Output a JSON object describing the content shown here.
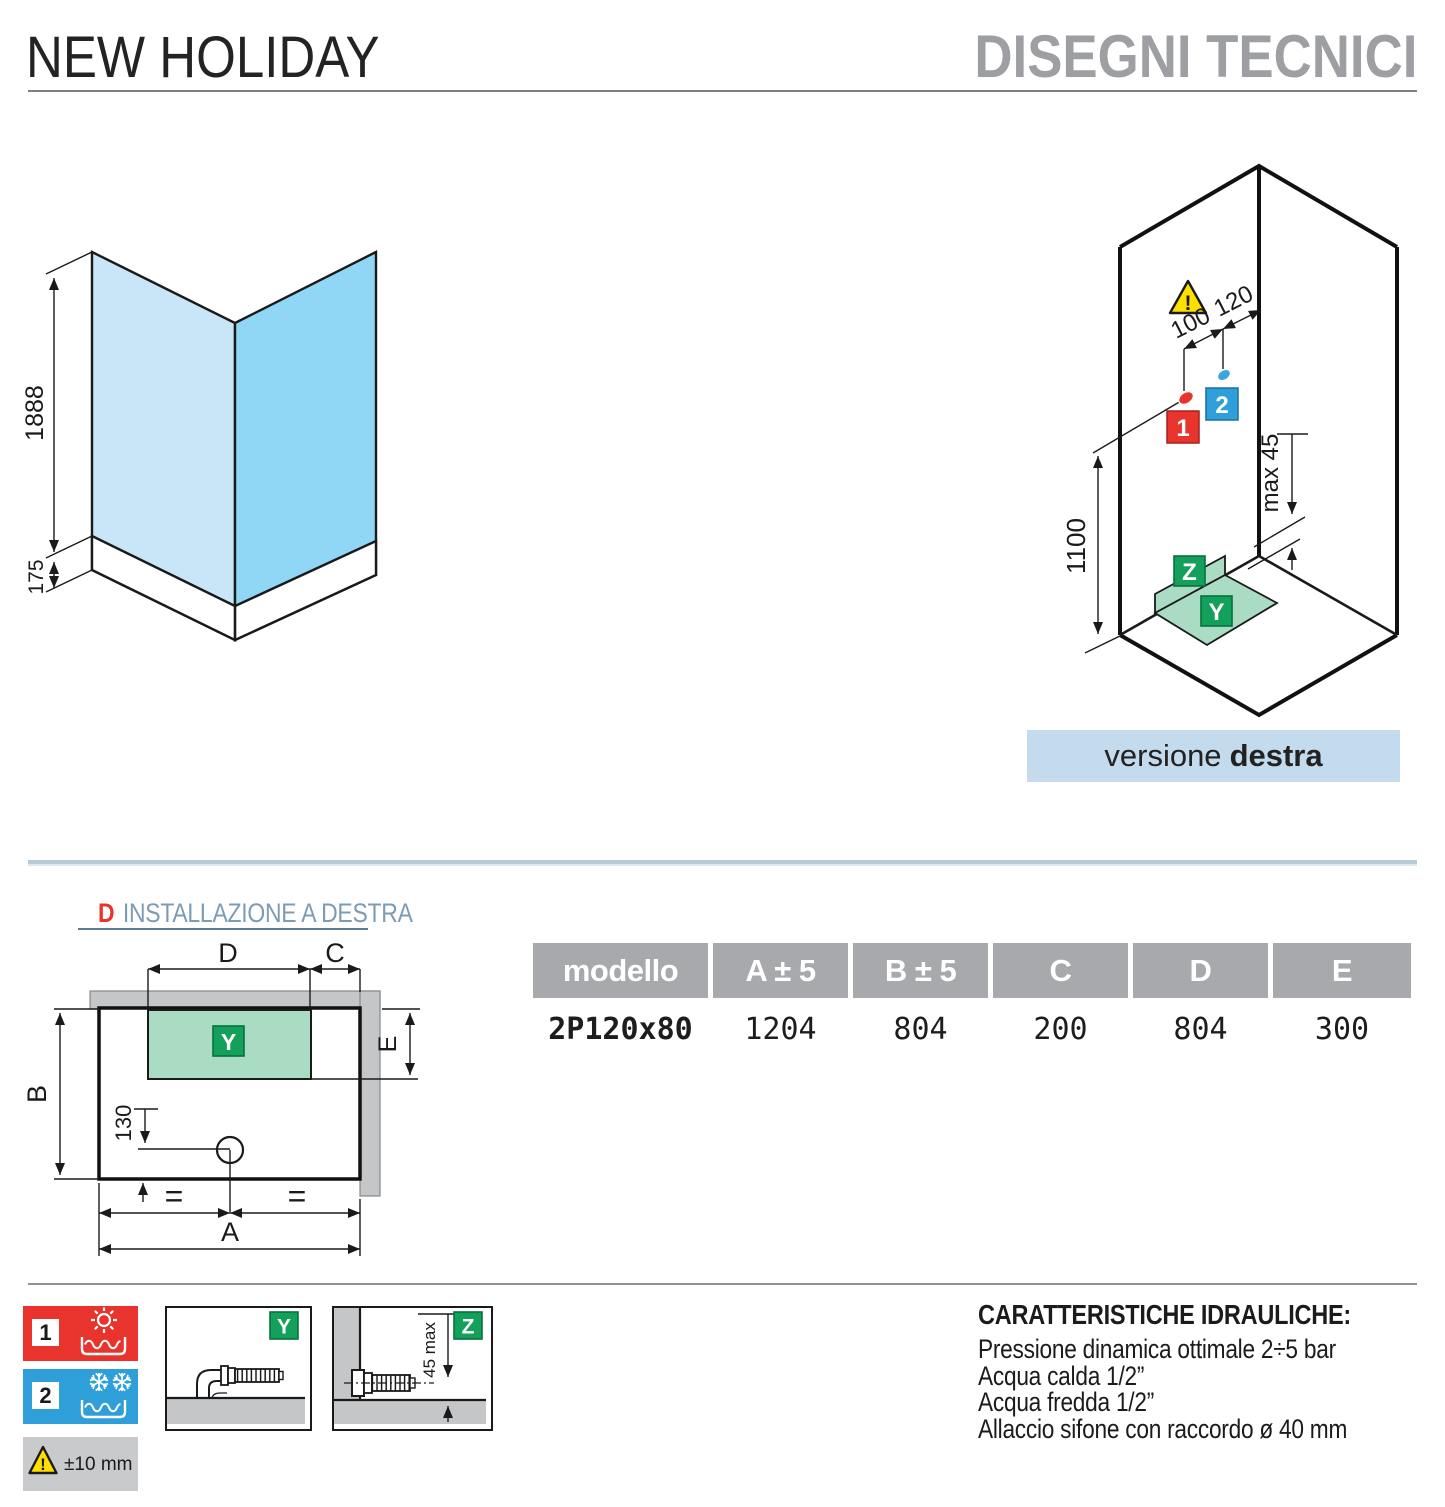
{
  "header": {
    "product": "NEW HOLIDAY",
    "section": "DISEGNI TECNICI"
  },
  "corner_drawing": {
    "height": "1888",
    "tray_height": "175"
  },
  "iso_drawing": {
    "warning": "!",
    "dim_hot_offset": "100",
    "dim_cold_offset": "120",
    "dim_height": "1100",
    "dim_wall_gap": "max 45",
    "hot_tag": "1",
    "cold_tag": "2",
    "drain_tag": "Z",
    "tray_tag": "Y"
  },
  "version_bar": {
    "prefix": "versione",
    "variant": "destra"
  },
  "installation": {
    "letter": "D",
    "title": "INSTALLAZIONE A DESTRA",
    "dim_d": "D",
    "dim_c": "C",
    "dim_e": "E",
    "dim_b": "B",
    "dim_a": "A",
    "dim_drain": "130",
    "equal_left": "=",
    "equal_right": "=",
    "tray_tag": "Y"
  },
  "table": {
    "headers": [
      "modello",
      "A ± 5",
      "B ± 5",
      "C",
      "D",
      "E"
    ],
    "row": [
      "2P120x80",
      "1204",
      "804",
      "200",
      "804",
      "300"
    ]
  },
  "legend": {
    "hot_tag": "1",
    "cold_tag": "2",
    "warning": "!",
    "tolerance": "±10 mm",
    "detail_y": {
      "tag": "Y"
    },
    "detail_z": {
      "tag": "Z",
      "dim": "45 max"
    }
  },
  "hydraulics": {
    "title": "CARATTERISTICHE IDRAULICHE:",
    "lines": [
      "Pressione dinamica ottimale 2÷5 bar",
      "Acqua calda 1/2”",
      "Acqua fredda 1/2”",
      "Allaccio sifone con raccordo ø 40 mm"
    ]
  },
  "colors": {
    "accent_red": "#e8342c",
    "accent_blue": "#2e9fd8",
    "accent_green": "#13a05a",
    "glass_left": "#c9e6f8",
    "glass_right": "#90d7f5",
    "tray_green": "#a9dcc3",
    "wall_gray": "#c5c6c8",
    "table_header_gray": "#a7a9ac",
    "version_bar_blue": "#c3dbed",
    "warning_yellow": "#ffdf00",
    "section_title_gray": "#9d9fa2",
    "install_title_blue": "#7d9cb4"
  }
}
